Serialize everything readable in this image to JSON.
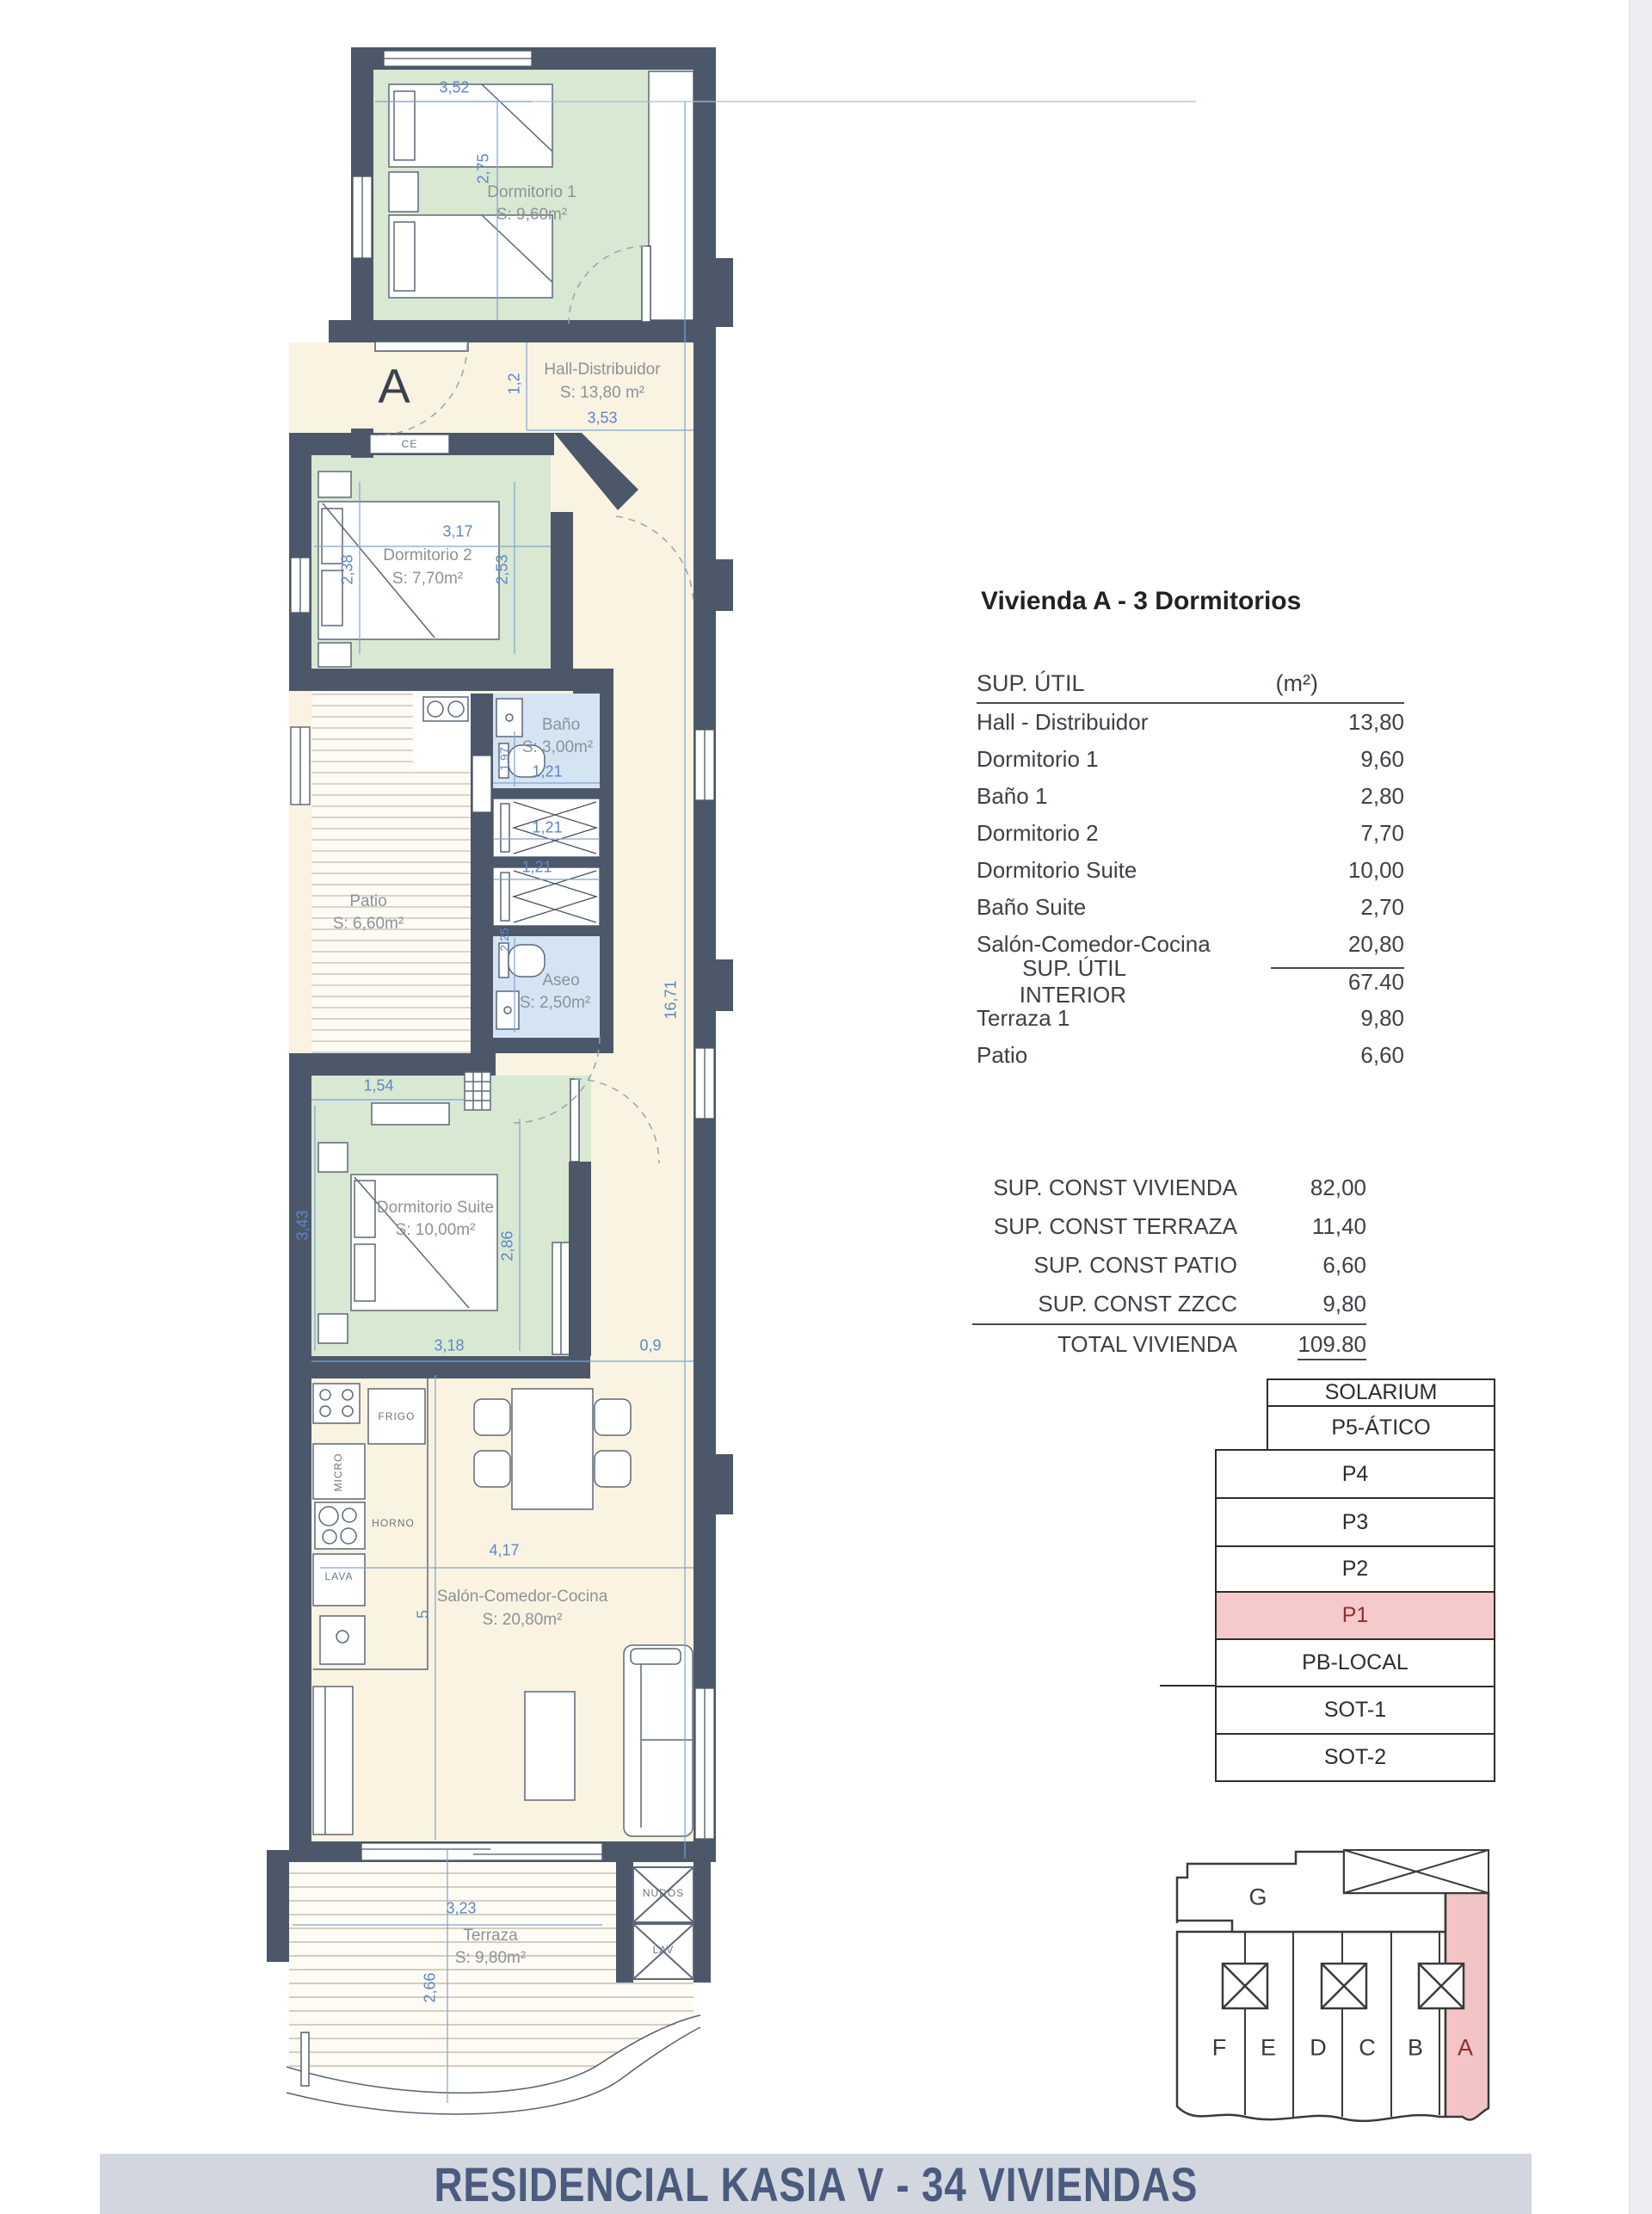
{
  "plan": {
    "unit_letter": "A",
    "wall_label": "CE",
    "rooms": [
      {
        "name": "Dormitorio 1",
        "area": "S: 9,60m²"
      },
      {
        "name": "Hall-Distribuidor",
        "area": "S: 13,80 m²"
      },
      {
        "name": "Dormitorio 2",
        "area": "S: 7,70m²"
      },
      {
        "name": "Baño",
        "area": "S: 3,00m²"
      },
      {
        "name": "Patio",
        "area": "S: 6,60m²"
      },
      {
        "name": "Aseo",
        "area": "S: 2,50m²"
      },
      {
        "name": "Dormitorio Suite",
        "area": "S: 10,00m²"
      },
      {
        "name": "Salón-Comedor-Cocina",
        "area": "S: 20,80m²"
      },
      {
        "name": "Terraza",
        "area": "S: 9,80m²"
      }
    ],
    "kitchen_labels": [
      "FRIGO",
      "MICRO",
      "HORNO",
      "LAVA"
    ],
    "utility_labels": [
      "NUDOS",
      "LAV"
    ],
    "dims": {
      "d352": "3,52",
      "d275": "2,75",
      "d12": "1,2",
      "d353": "3,53",
      "d317": "3,17",
      "d238": "2,38",
      "d253": "2,53",
      "d197": "1,97",
      "d121a": "1,21",
      "d121b": "1,21",
      "d121c": "1,21",
      "d225": "2,25",
      "d154": "1,54",
      "d343": "3,43",
      "d286": "2,86",
      "d318": "3,18",
      "d09": "0,9",
      "d1671": "16,71",
      "d417": "4,17",
      "d5": "5",
      "d323": "3,23",
      "d266": "2,66"
    }
  },
  "summary": {
    "title": "Vivienda A - 3 Dormitorios",
    "util": {
      "header": "SUP. ÚTIL",
      "unit": "(m²)",
      "rows": [
        {
          "label": "Hall - Distribuidor",
          "value": "13,80"
        },
        {
          "label": "Dormitorio 1",
          "value": "9,60"
        },
        {
          "label": "Baño 1",
          "value": "2,80"
        },
        {
          "label": "Dormitorio 2",
          "value": "7,70"
        },
        {
          "label": "Dormitorio Suite",
          "value": "10,00"
        },
        {
          "label": "Baño Suite",
          "value": "2,70"
        },
        {
          "label": "Salón-Comedor-Cocina",
          "value": "20,80"
        }
      ],
      "subtotal": {
        "label": "SUP. ÚTIL INTERIOR",
        "value": "67.40"
      },
      "extra": [
        {
          "label": "Terraza 1",
          "value": "9,80"
        },
        {
          "label": "Patio",
          "value": "6,60"
        }
      ]
    },
    "const": {
      "rows": [
        {
          "label": "SUP. CONST VIVIENDA",
          "value": "82,00"
        },
        {
          "label": "SUP. CONST TERRAZA",
          "value": "11,40"
        },
        {
          "label": "SUP. CONST PATIO",
          "value": "6,60"
        },
        {
          "label": "SUP. CONST ZZCC",
          "value": "9,80"
        }
      ],
      "total": {
        "label": "TOTAL VIVIENDA",
        "value": "109.80"
      }
    }
  },
  "levels": {
    "floors": [
      {
        "label": "SOLARIUM"
      },
      {
        "label": "P5-ÁTICO"
      },
      {
        "label": "P4"
      },
      {
        "label": "P3"
      },
      {
        "label": "P2"
      },
      {
        "label": "P1",
        "highlight": true
      },
      {
        "label": "PB-LOCAL"
      },
      {
        "label": "SOT-1"
      },
      {
        "label": "SOT-2"
      }
    ]
  },
  "site": {
    "block_label": "G",
    "units": [
      "F",
      "E",
      "D",
      "C",
      "B",
      "A"
    ],
    "highlighted_unit": "A"
  },
  "footer": {
    "title": "RESIDENCIAL KASIA V - 34 VIVIENDAS"
  },
  "colors": {
    "wall": "#4c5869",
    "room_green": "#d8e8d2",
    "room_blue": "#d4e4f3",
    "interior_cream": "#faf3e1",
    "dim_blue": "#5d87c7",
    "highlight_pink": "#f6caca",
    "highlight_text": "#8a3030",
    "footer_bg": "#d2d7df",
    "footer_text": "#4b5b7e"
  }
}
